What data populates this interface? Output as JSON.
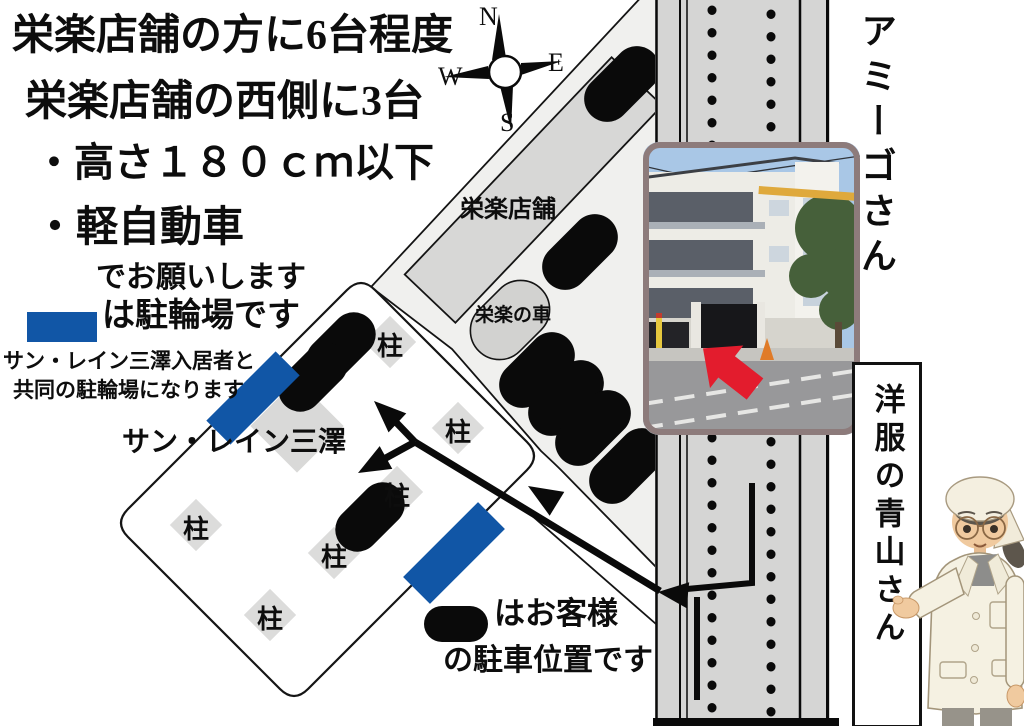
{
  "instructions": {
    "line1": "栄楽店舗の方に6台程度",
    "line2": "栄楽店舗の西側に3台",
    "bullet1": "・高さ１８０ｃｍ以下",
    "bullet2": "・軽自動車",
    "bullet3": "でお願いします"
  },
  "bicycle_legend": {
    "label": "は駐輪場です",
    "note_line1": "サン・レイン三澤入居者と",
    "note_line2": "共同の駐輪場になります"
  },
  "customer_legend": {
    "line1": "はお客様",
    "line2": "の駐車位置です"
  },
  "compass": {
    "north": "N",
    "east": "E",
    "west": "W",
    "south": "S"
  },
  "map_labels": {
    "eiraku_store": "栄楽店舗",
    "eiraku_car": "栄楽の車",
    "sun_rain_misawa": "サン・レイン三澤",
    "pillar": "柱"
  },
  "neighbors": {
    "amigo": "アミーゴさん",
    "aoyama": "洋服の青山さん"
  },
  "colors": {
    "bicycle_blue": "#1156a6",
    "road_gray": "#d5d5d4",
    "photo_frame": "#8d7b7b",
    "arrow_red": "#e31c2d"
  }
}
